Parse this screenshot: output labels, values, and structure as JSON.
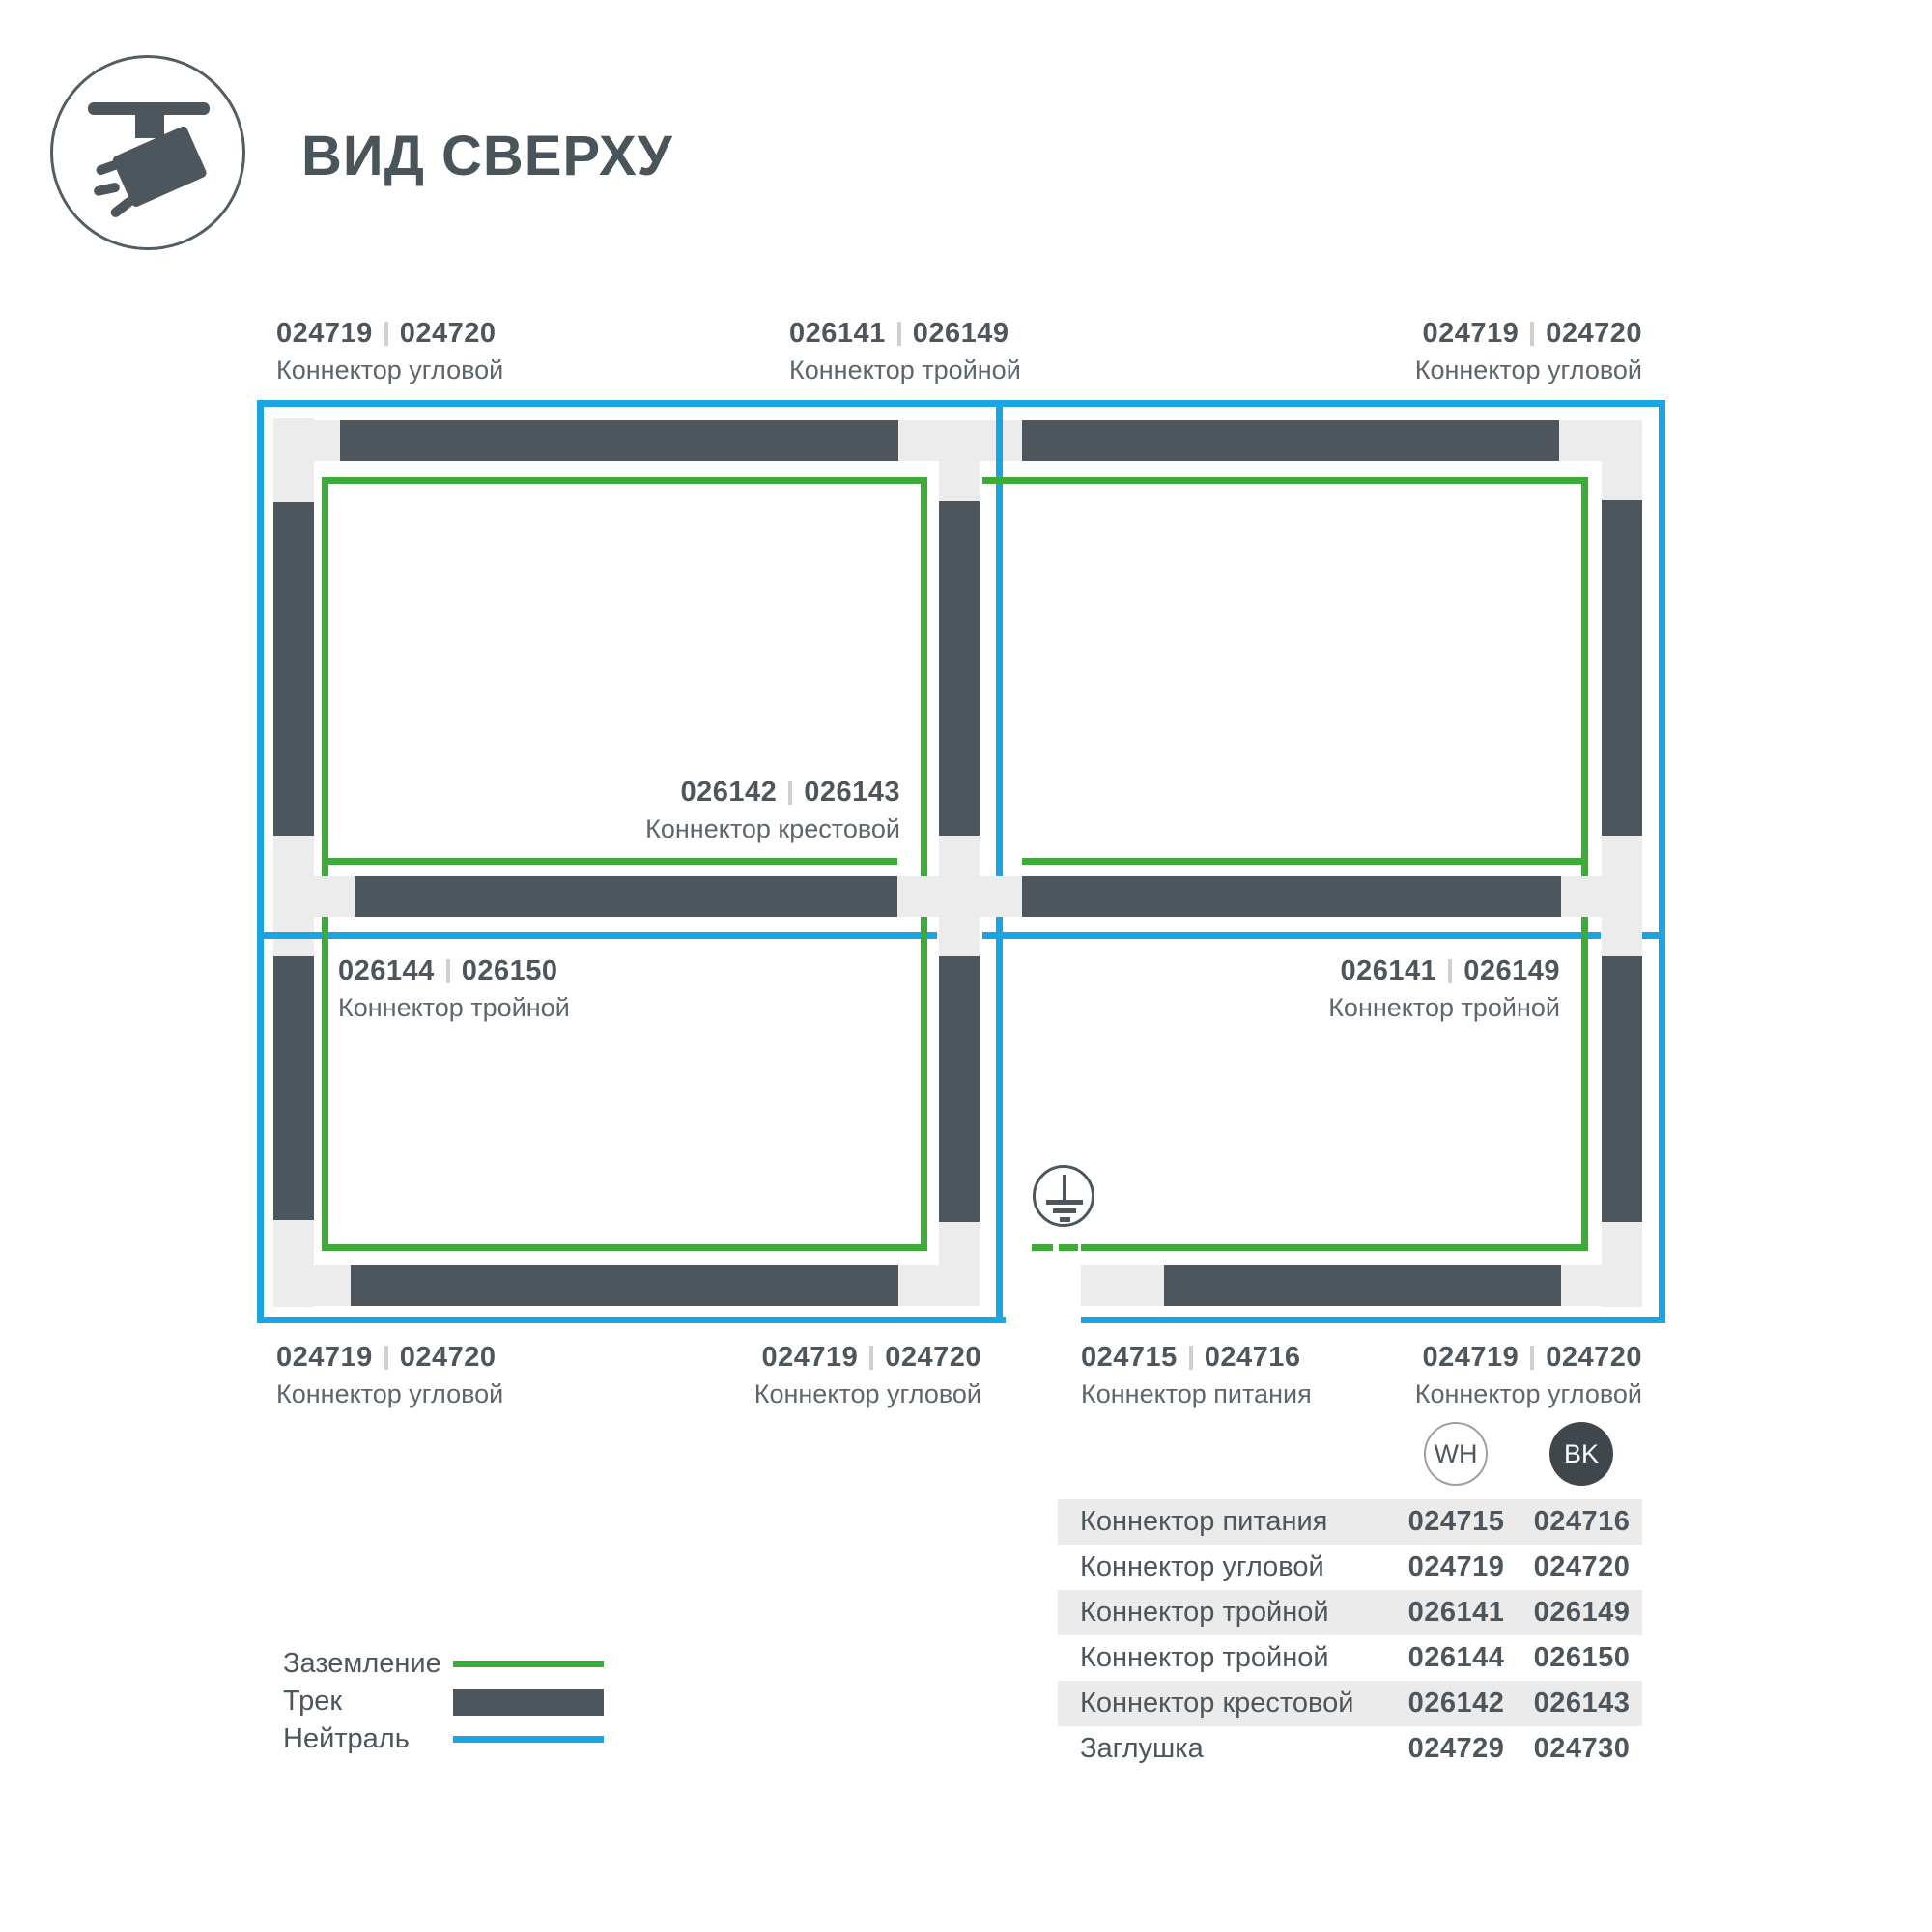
{
  "header": {
    "title": "ВИД СВЕРХУ",
    "icon": "track-spotlight-icon"
  },
  "colors": {
    "ground_green": "#3cab37",
    "neutral_blue": "#1ba4e2",
    "track_dark": "#4d565c",
    "connector_light": "#ececed"
  },
  "diagram": {
    "labels": [
      {
        "code_wh": "024719",
        "code_bk": "024720",
        "name": "Коннектор угловой"
      },
      {
        "code_wh": "026141",
        "code_bk": "026149",
        "name": "Коннектор тройной"
      },
      {
        "code_wh": "024719",
        "code_bk": "024720",
        "name": "Коннектор угловой"
      },
      {
        "code_wh": "026142",
        "code_bk": "026143",
        "name": "Коннектор крестовой"
      },
      {
        "code_wh": "026144",
        "code_bk": "026150",
        "name": "Коннектор тройной"
      },
      {
        "code_wh": "026141",
        "code_bk": "026149",
        "name": "Коннектор тройной"
      },
      {
        "code_wh": "024719",
        "code_bk": "024720",
        "name": "Коннектор угловой"
      },
      {
        "code_wh": "024719",
        "code_bk": "024720",
        "name": "Коннектор угловой"
      },
      {
        "code_wh": "024715",
        "code_bk": "024716",
        "name": "Коннектор питания"
      },
      {
        "code_wh": "024719",
        "code_bk": "024720",
        "name": "Коннектор угловой"
      }
    ]
  },
  "legend": {
    "items": [
      {
        "label": "Заземление",
        "swatch": "ground-line"
      },
      {
        "label": "Трек",
        "swatch": "track-bar"
      },
      {
        "label": "Нейтраль",
        "swatch": "neutral-line"
      }
    ]
  },
  "table": {
    "col_headers": [
      {
        "label": "WH"
      },
      {
        "label": "BK"
      }
    ],
    "rows": [
      {
        "name": "Коннектор питания",
        "wh": "024715",
        "bk": "024716"
      },
      {
        "name": "Коннектор угловой",
        "wh": "024719",
        "bk": "024720"
      },
      {
        "name": "Коннектор тройной",
        "wh": "026141",
        "bk": "026149"
      },
      {
        "name": "Коннектор тройной",
        "wh": "026144",
        "bk": "026150"
      },
      {
        "name": "Коннектор крестовой",
        "wh": "026142",
        "bk": "026143"
      },
      {
        "name": "Заглушка",
        "wh": "024729",
        "bk": "024730"
      }
    ]
  }
}
